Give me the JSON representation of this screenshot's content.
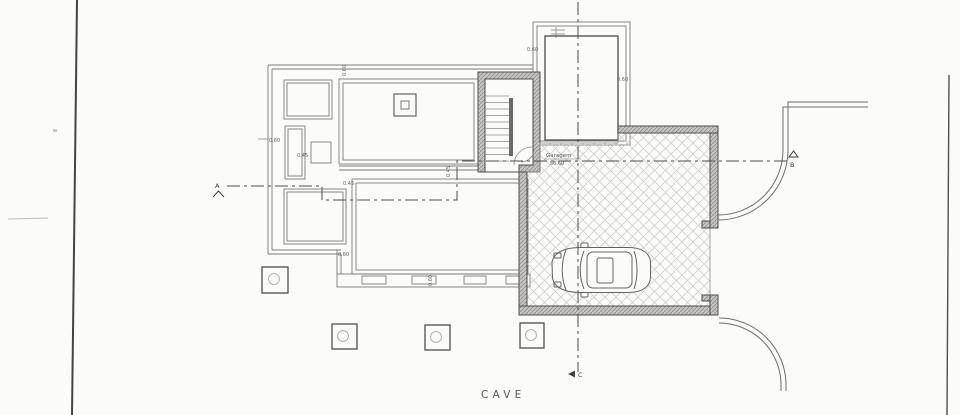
{
  "plan": {
    "title": "CAVE",
    "garage": {
      "name": "Garagem",
      "area": "56.60"
    },
    "markers": {
      "a": "A",
      "b": "B",
      "c": "C"
    },
    "dims": {
      "d60": "0.60",
      "d45": "0.45"
    },
    "colors": {
      "paper": "#fbfbf8",
      "ink": "#4f4d49",
      "thin_line": "#7d7b75",
      "wall_fill": "#c6c5c0",
      "wall_hatch": "#8f8e89",
      "floor_hatch": "#d0cfca"
    }
  }
}
